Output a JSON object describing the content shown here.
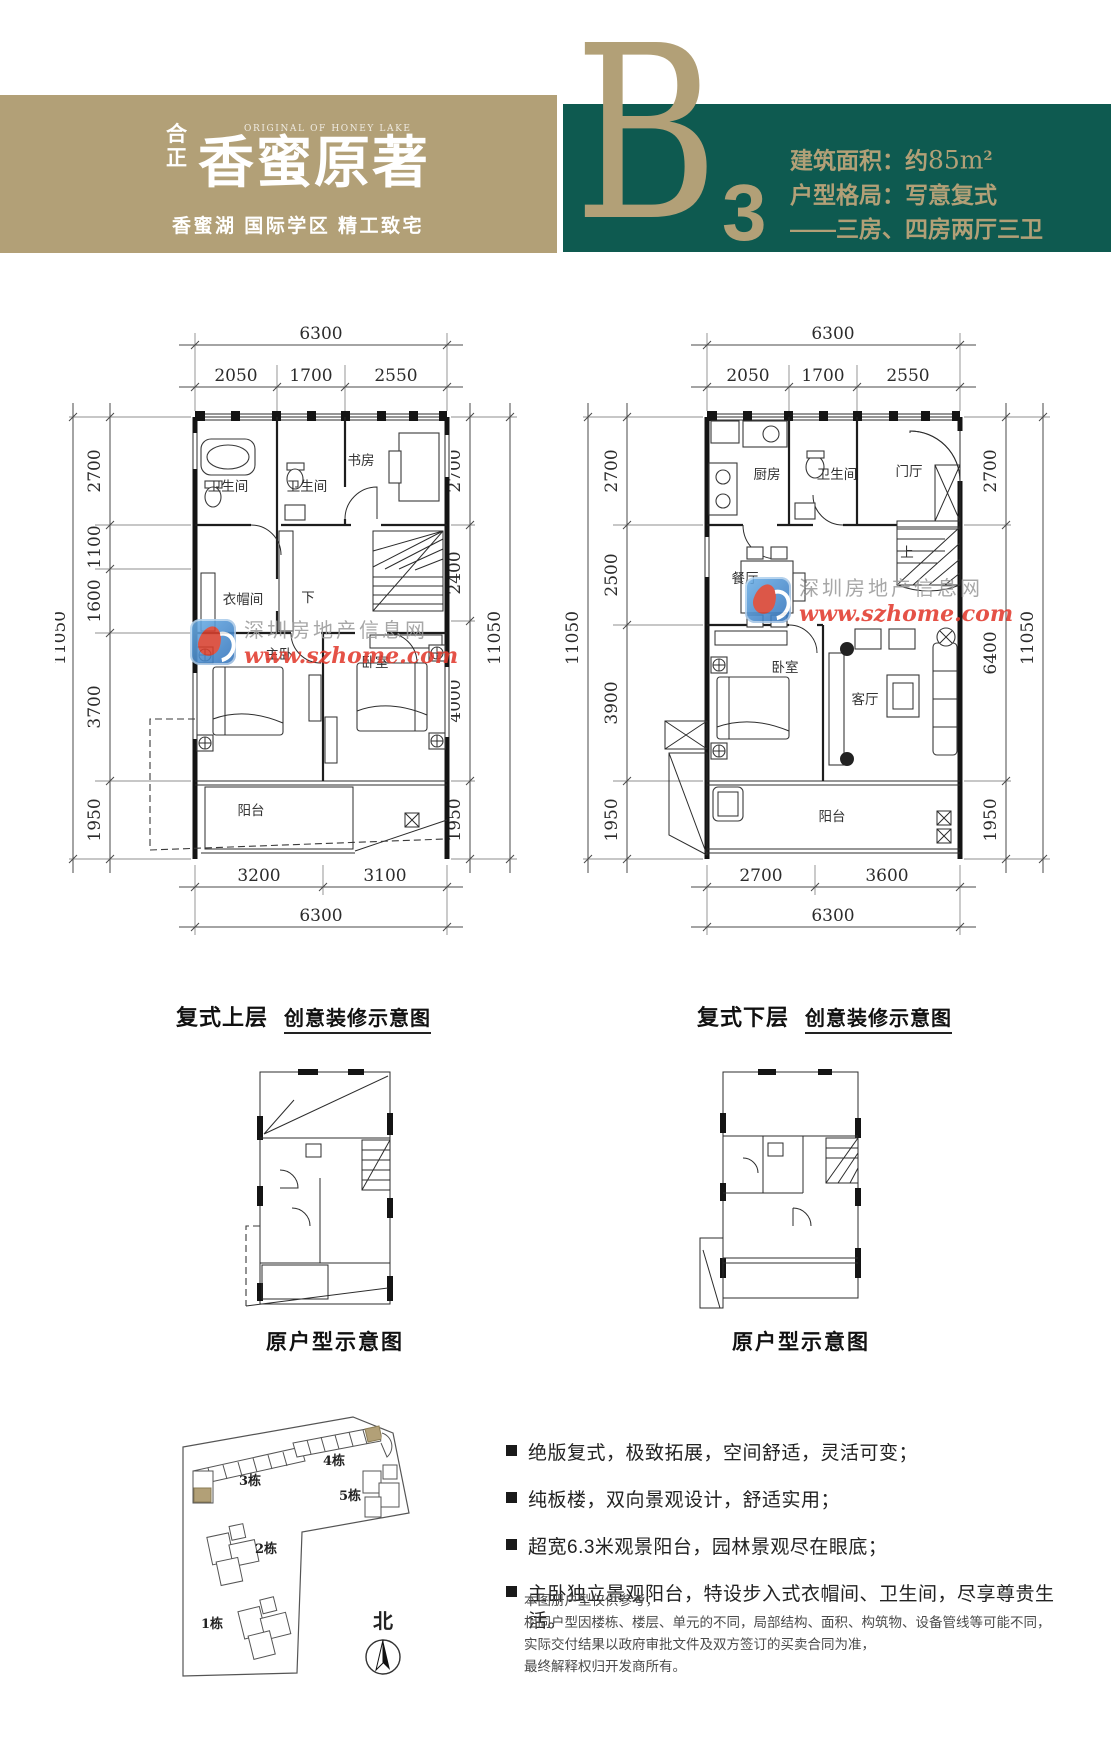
{
  "colors": {
    "gold": "#b2a077",
    "teal": "#0e5a50",
    "watermark_red": "#e23b2e",
    "watermark_blue": "#2f6fb8"
  },
  "header": {
    "brand_mark_top": "合",
    "brand_mark_bottom": "正",
    "brand_en": "ORIGINAL OF HONEY LAKE",
    "brand_name": "香蜜原著",
    "tagline": "香蜜湖 国际学区 精工致宅",
    "unit_letter": "B",
    "unit_number": "3",
    "spec_area_label": "建筑面积：约",
    "spec_area_value": "85m",
    "spec_area_sup": "2",
    "spec_layout": "户型格局：写意复式",
    "spec_rooms": "——三房、四房两厅三卫"
  },
  "watermark": {
    "site_name": "深圳房地产信息网",
    "site_url": "www.szhome.com"
  },
  "plans": {
    "upper": {
      "caption_title": "复式上层",
      "caption_sub": "创意装修示意图",
      "dims": {
        "top_total": "6300",
        "top_segments": [
          "2050",
          "1700",
          "2550"
        ],
        "bottom_segments": [
          "3200",
          "3100"
        ],
        "bottom_total": "6300",
        "left_total": "11050",
        "left_segments": [
          "2700",
          "1100",
          "1600",
          "3700",
          "1950"
        ],
        "right_segments": [
          "2700",
          "2400",
          "4000",
          "1950"
        ],
        "right_total": "11050"
      },
      "rooms": {
        "bath1": "卫生间",
        "bath2": "卫生间",
        "study": "书房",
        "cloak": "衣帽间",
        "master": "主卧",
        "bedroom": "卧室",
        "balcony": "阳台",
        "stair": "下"
      }
    },
    "lower": {
      "caption_title": "复式下层",
      "caption_sub": "创意装修示意图",
      "dims": {
        "top_total": "6300",
        "top_segments": [
          "2050",
          "1700",
          "2550"
        ],
        "bottom_segments": [
          "2700",
          "3600"
        ],
        "bottom_total": "6300",
        "left_total": "11050",
        "left_segments": [
          "2700",
          "2500",
          "3900",
          "1950"
        ],
        "right_segments": [
          "2700",
          "6400",
          "1950"
        ],
        "right_total": "11050"
      },
      "rooms": {
        "kitchen": "厨房",
        "bath": "卫生间",
        "foyer": "门厅",
        "dining": "餐厅",
        "bedroom": "卧室",
        "living": "客厅",
        "balcony": "阳台",
        "stair": "上"
      }
    }
  },
  "original_plans": {
    "left_caption": "原户型示意图",
    "right_caption": "原户型示意图"
  },
  "site_plan": {
    "buildings": [
      "1栋",
      "2栋",
      "3栋",
      "4栋",
      "5栋"
    ],
    "north_label": "北"
  },
  "features": [
    "绝版复式，极致拓展，空间舒适，灵活可变；",
    "纯板楼，双向景观设计，舒适实用；",
    "超宽6.3米观景阳台，园林景观尽在眼底；",
    "主卧独立景观阳台，特设步入式衣帽间、卫生间，尽享尊贵生活。"
  ],
  "disclaimer": [
    "本图册户型仅供参考，",
    "相同户型因楼栋、楼层、单元的不同，局部结构、面积、构筑物、设备管线等可能不同，",
    "实际交付结果以政府审批文件及双方签订的买卖合同为准，",
    "最终解释权归开发商所有。"
  ]
}
